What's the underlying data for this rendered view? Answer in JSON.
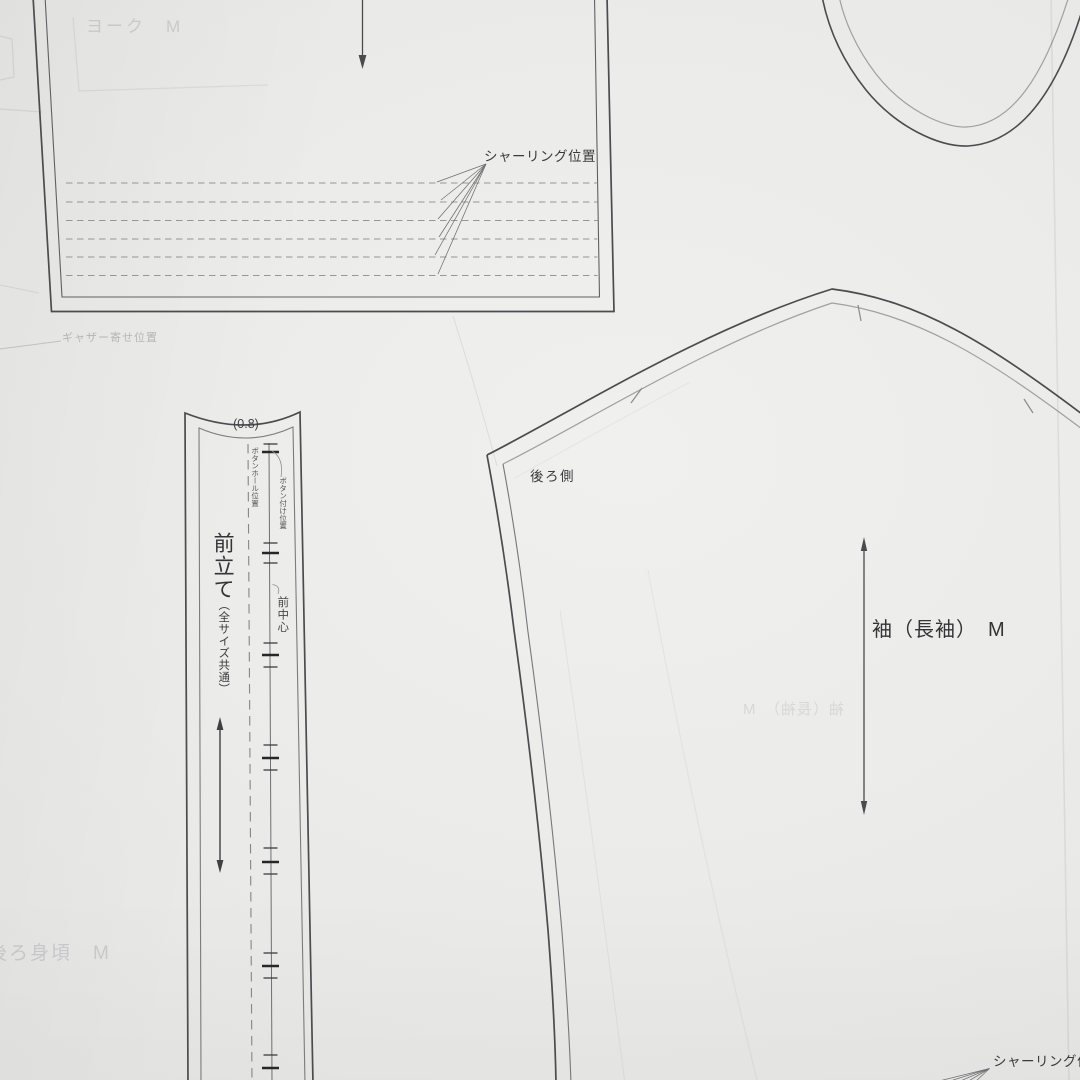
{
  "sheet": {
    "description": "Japanese sewing pattern sheet (photographed paper with pattern pieces)",
    "labels": {
      "shirring_top": "シャーリング位置",
      "shirring_bottom": "シャーリング位置",
      "seam_allowance": "(0.8)",
      "placket_name": "前立て",
      "placket_size": "（全サイズ共通）",
      "center_front": "前中心",
      "buttonhole_pos": "ボタンホール位置",
      "button_pos": "ボタン付け位置",
      "sleeve_side": "後ろ側",
      "sleeve_name": "袖（長袖）　M"
    },
    "bleed_labels": {
      "yoke": "ヨーク　M",
      "gather": "ギャザー寄せ位置",
      "back_bodice": "後ろ身頃　M",
      "sleeve_mirrored": "袖（長袖）　M"
    },
    "structure": {
      "shirring_line_count_top": 6,
      "buttonhole_tick_groups": 7
    },
    "colors": {
      "paper": "#ebebe9",
      "cut_line": "#4b4b50",
      "seam_line": "#9fa0a4",
      "dashed_line": "#95959a",
      "text": "#39393d"
    }
  }
}
